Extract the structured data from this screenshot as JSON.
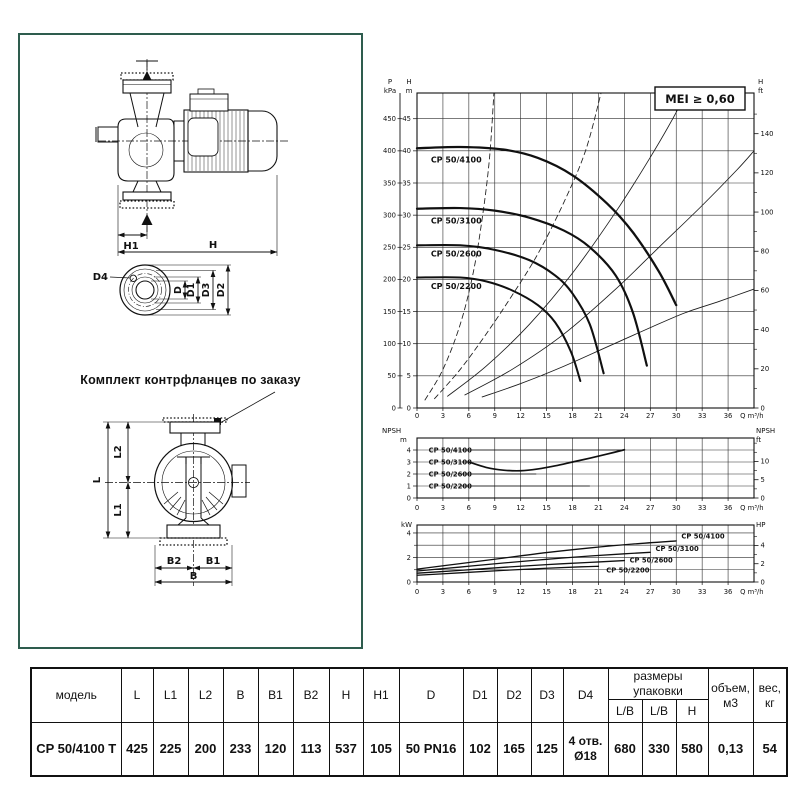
{
  "drawing": {
    "caption": "Комплект контрфланцев по заказу",
    "labels": {
      "h": "H",
      "h1": "H1",
      "l": "L",
      "l1": "L1",
      "l2": "L2",
      "b": "B",
      "b1": "B1",
      "b2": "B2",
      "d": "D",
      "d1": "D1",
      "d2": "D2",
      "d3": "D3",
      "d4": "D4"
    }
  },
  "chart_data": [
    {
      "id": "head",
      "type": "line",
      "badge": "MEI ≥ 0,60",
      "x_axis": {
        "label": "Q m³/h",
        "ticks": [
          0,
          3,
          6,
          9,
          12,
          15,
          18,
          21,
          24,
          27,
          30,
          33,
          36
        ],
        "max": 39
      },
      "y_left_outer": {
        "title": [
          "P",
          "kPa"
        ],
        "ticks": [
          0,
          50,
          100,
          150,
          200,
          250,
          300,
          350,
          400,
          450
        ]
      },
      "y_left": {
        "title": [
          "H",
          "m"
        ],
        "ticks": [
          0,
          5,
          10,
          15,
          20,
          25,
          30,
          35,
          40,
          45
        ],
        "grid": [
          5,
          10,
          15,
          20,
          25,
          30,
          35,
          40,
          45
        ],
        "max": 49
      },
      "y_right": {
        "title": [
          "H",
          "ft"
        ],
        "major": [
          0,
          20,
          40,
          60,
          80,
          100,
          120,
          140
        ],
        "minor": [
          10,
          30,
          50,
          70,
          90,
          110,
          130,
          150
        ],
        "unit_m": 0.3048
      },
      "series": [
        {
          "name": "CP 50/4100",
          "width": 2.3,
          "label_xy": [
            1.6,
            38.2
          ],
          "points": [
            [
              0,
              40.4
            ],
            [
              5,
              40.6
            ],
            [
              10,
              40.2
            ],
            [
              14,
              38.9
            ],
            [
              18,
              36.2
            ],
            [
              22,
              31.8
            ],
            [
              25,
              27.3
            ],
            [
              28,
              21.2
            ],
            [
              30,
              16
            ]
          ]
        },
        {
          "name": "CP 50/3100",
          "width": 2.2,
          "label_xy": [
            1.6,
            28.7
          ],
          "points": [
            [
              0,
              31
            ],
            [
              5,
              31.1
            ],
            [
              9,
              30.7
            ],
            [
              13,
              29.6
            ],
            [
              17,
              27.6
            ],
            [
              20,
              25
            ],
            [
              23,
              20.6
            ],
            [
              25,
              14.8
            ],
            [
              26.6,
              6.6
            ]
          ]
        },
        {
          "name": "CP 50/2600",
          "width": 2.1,
          "label_xy": [
            1.6,
            23.6
          ],
          "points": [
            [
              0,
              25.3
            ],
            [
              5,
              25.3
            ],
            [
              9,
              24.6
            ],
            [
              13,
              23
            ],
            [
              16,
              20.6
            ],
            [
              18,
              17.8
            ],
            [
              20,
              13
            ],
            [
              21.6,
              5.4
            ]
          ]
        },
        {
          "name": "CP 50/2200",
          "width": 2.0,
          "label_xy": [
            1.6,
            18.5
          ],
          "points": [
            [
              0,
              20.3
            ],
            [
              5,
              20.3
            ],
            [
              8,
              19.7
            ],
            [
              11,
              18.3
            ],
            [
              14,
              16
            ],
            [
              16,
              13.3
            ],
            [
              17.8,
              8.8
            ],
            [
              18.9,
              4.2
            ]
          ]
        }
      ],
      "aux_lines": [
        {
          "dash": true,
          "points": [
            [
              0.9,
              1.2
            ],
            [
              3,
              6
            ],
            [
              5,
              13
            ],
            [
              6.5,
              21
            ],
            [
              7.6,
              30
            ],
            [
              8.4,
              39
            ],
            [
              8.9,
              49
            ]
          ]
        },
        {
          "dash": true,
          "points": [
            [
              2,
              1.4
            ],
            [
              5,
              6
            ],
            [
              8,
              11.5
            ],
            [
              11,
              17.5
            ],
            [
              14,
              24
            ],
            [
              17,
              32
            ],
            [
              19.5,
              40
            ],
            [
              21.3,
              49
            ]
          ]
        },
        {
          "dash": false,
          "points": [
            [
              3.5,
              1.8
            ],
            [
              8,
              6.5
            ],
            [
              13,
              13
            ],
            [
              18,
              21
            ],
            [
              23,
              30.5
            ],
            [
              27,
              39
            ],
            [
              30,
              46
            ],
            [
              31,
              49
            ]
          ]
        },
        {
          "dash": false,
          "points": [
            [
              5.5,
              2
            ],
            [
              11,
              6
            ],
            [
              17,
              11.5
            ],
            [
              23,
              18.5
            ],
            [
              28,
              25
            ],
            [
              33,
              31.5
            ],
            [
              37,
              37
            ],
            [
              39,
              40
            ]
          ]
        },
        {
          "dash": false,
          "points": [
            [
              7.5,
              1.7
            ],
            [
              12,
              3.8
            ],
            [
              17,
              6.5
            ],
            [
              22,
              9.5
            ],
            [
              27,
              12.5
            ],
            [
              31,
              14.8
            ],
            [
              35,
              16.6
            ],
            [
              39,
              18.5
            ]
          ]
        }
      ]
    },
    {
      "id": "npsh",
      "type": "line",
      "x_axis": {
        "label": "Q m³/h",
        "ticks": [
          0,
          3,
          6,
          9,
          12,
          15,
          18,
          21,
          24,
          27,
          30,
          33,
          36
        ],
        "max": 39
      },
      "y_left": {
        "title": [
          "NPSH",
          "m"
        ],
        "ticks": [
          0,
          1,
          2,
          3,
          4
        ],
        "grid": [
          1,
          2,
          3,
          4
        ],
        "max": 5
      },
      "y_right": {
        "title": [
          "NPSH",
          "ft"
        ],
        "major": [
          0,
          5,
          10
        ],
        "minor": [
          2.5,
          7.5,
          12.5,
          15
        ],
        "unit_m": 0.3048
      },
      "series": [
        {
          "name": "NPSH",
          "width": 1.7,
          "points": [
            [
              6,
              3
            ],
            [
              8,
              2.55
            ],
            [
              10,
              2.32
            ],
            [
              12,
              2.27
            ],
            [
              14,
              2.42
            ],
            [
              16,
              2.68
            ],
            [
              18,
              3
            ],
            [
              20,
              3.32
            ],
            [
              22,
              3.66
            ],
            [
              24,
              4.02
            ]
          ]
        }
      ],
      "callouts": [
        {
          "text": "CP 50/4100",
          "y": 4,
          "line": [
            5.2,
            24
          ]
        },
        {
          "text": "CP 50/3100",
          "y": 3,
          "line": [
            5.2,
            6.2
          ]
        },
        {
          "text": "CP 50/2600",
          "y": 2,
          "line": [
            5.0,
            13.8
          ]
        },
        {
          "text": "CP 50/2200",
          "y": 1,
          "line": [
            5.0,
            20
          ]
        }
      ]
    },
    {
      "id": "power",
      "type": "line",
      "x_axis": {
        "label": "Q m³/h",
        "ticks": [
          0,
          3,
          6,
          9,
          12,
          15,
          18,
          21,
          24,
          27,
          30,
          33,
          36
        ],
        "max": 39
      },
      "y_left": {
        "title": [
          "kW"
        ],
        "ticks": [
          0,
          2,
          4
        ],
        "minor": [
          1,
          3
        ],
        "grid": [
          1,
          2,
          3,
          4
        ],
        "max": 4.65
      },
      "y_right": {
        "title": [
          "HP"
        ],
        "major": [
          0,
          2,
          4
        ],
        "minor": [
          1,
          3,
          5
        ],
        "unit_m": 0.7457
      },
      "series": [
        {
          "name": "CP 50/4100",
          "width": 1.3,
          "label_xy": [
            30.6,
            3.55
          ],
          "points": [
            [
              0,
              1.05
            ],
            [
              5,
              1.5
            ],
            [
              10,
              1.95
            ],
            [
              15,
              2.4
            ],
            [
              20,
              2.78
            ],
            [
              25,
              3.1
            ],
            [
              30,
              3.35
            ]
          ]
        },
        {
          "name": "CP 50/3100",
          "width": 1.3,
          "label_xy": [
            27.6,
            2.52
          ],
          "points": [
            [
              0,
              0.9
            ],
            [
              5,
              1.22
            ],
            [
              10,
              1.55
            ],
            [
              15,
              1.85
            ],
            [
              20,
              2.12
            ],
            [
              24,
              2.3
            ],
            [
              27,
              2.42
            ]
          ]
        },
        {
          "name": "CP 50/2600",
          "width": 1.3,
          "label_xy": [
            24.6,
            1.58
          ],
          "points": [
            [
              0,
              0.72
            ],
            [
              5,
              0.95
            ],
            [
              10,
              1.2
            ],
            [
              15,
              1.42
            ],
            [
              20,
              1.6
            ],
            [
              24,
              1.75
            ]
          ]
        },
        {
          "name": "CP 50/2200",
          "width": 1.3,
          "label_xy": [
            21.9,
            0.78
          ],
          "points": [
            [
              0,
              0.55
            ],
            [
              5,
              0.75
            ],
            [
              10,
              0.95
            ],
            [
              15,
              1.12
            ],
            [
              19,
              1.24
            ],
            [
              21,
              1.28
            ]
          ]
        }
      ]
    }
  ],
  "table": {
    "model_header": "модель",
    "dim_headers": [
      "L",
      "L1",
      "L2",
      "B",
      "B1",
      "B2",
      "H",
      "H1",
      "D",
      "D1",
      "D2",
      "D3",
      "D4"
    ],
    "pack_header": "размеры упаковки",
    "pack_sub_headers": [
      "L/B",
      "L/B",
      "H"
    ],
    "volume_header_line1": "объем,",
    "volume_header_line2": "м3",
    "weight_header_line1": "вес,",
    "weight_header_line2": "кг",
    "row": {
      "model": "CP 50/4100 T",
      "dims": [
        "425",
        "225",
        "200",
        "233",
        "120",
        "113",
        "537",
        "105",
        "50 PN16",
        "102",
        "165",
        "125"
      ],
      "d4_line1": "4 отв.",
      "d4_line2": "Ø18",
      "pack": [
        "680",
        "330",
        "580"
      ],
      "volume": "0,13",
      "weight": "54"
    }
  }
}
